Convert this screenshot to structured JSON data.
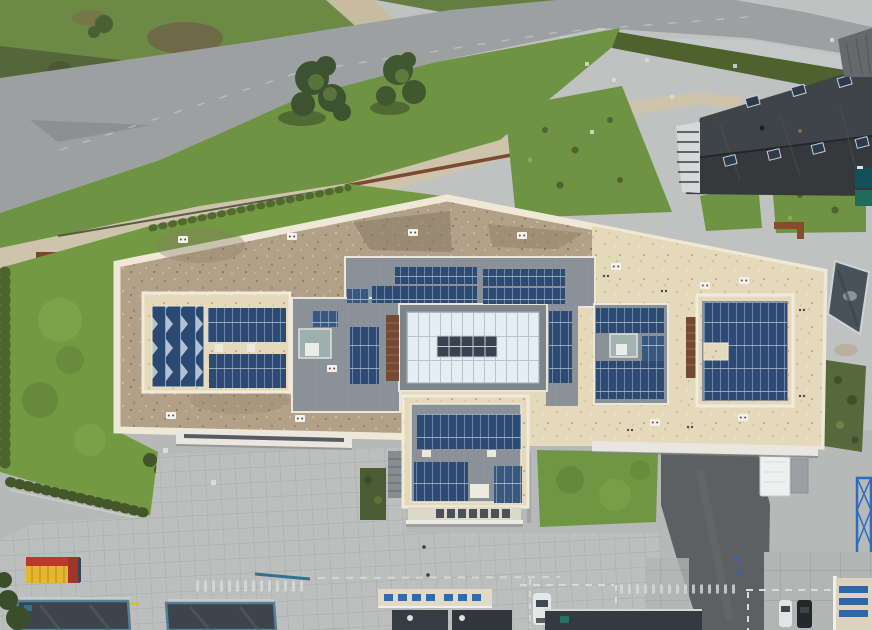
{
  "scene": {
    "type": "aerial-drone-photograph",
    "description": "Top-down aerial drone photo of a large modern flat-roof commercial building covered with photovoltaic solar panel arrays around a central glass atrium skylight, surrounded by a curved road, lawns, hedges, paved plazas, parking areas with dashed markings, a yellow shipping container, a white box truck, cars and neighbouring dark-roofed buildings",
    "view": "nadir (straight down)",
    "lighting": "overcast daylight"
  },
  "palette": {
    "solar_panel_blue": "#2c4a72",
    "solar_panel_light_blue": "#38587f",
    "gravel_roof_brown": "#b2a188",
    "gravel_roof_cream": "#e5d9bb",
    "roof_tile_grey": "#8b9299",
    "skylight_glass": "#e4eef4",
    "parapet_white": "#efe8d6",
    "grass_green": "#6f9743",
    "hedge_green": "#4a5e2d",
    "asphalt_road_grey": "#9ca0a1",
    "concrete_plaza_grey": "#bdbfbe",
    "dark_asphalt": "#5d6062",
    "neighbor_dark_roof": "#35393c",
    "rust_brown": "#744a35",
    "container_yellow": "#e5b62f",
    "container_red": "#b93a2c",
    "truck_white": "#eef0ef",
    "facade_blue": "#2e6bb4"
  },
  "main_building": {
    "roof_shape": "elongated angular flat roof with white parapets",
    "solar_panel_arrays": 18,
    "sawtooth_array": 1,
    "central_skylight": {
      "glass_grid_columns": 12,
      "glass_grid_rows": 3,
      "dark_roof_vents": 10
    },
    "small_square_skylights": 2,
    "rust_collector_strips": 2,
    "white_vent_boxes": 12,
    "annex": {
      "solar_panel_arrays": 3,
      "loading_bays": 7
    }
  },
  "surroundings": {
    "roads": "curved two-lane road running from left edge to upper right corner with traffic island and fork",
    "lawns": 6,
    "hedgerows": 4,
    "trees": 3,
    "neighbor_buildings": [
      "black gable-roof building with roof windows and half-timbered gable (top right)",
      "grey ribbed roof (top right corner)",
      "two dark flat-roof halls with blue-green steel frames (bottom left)",
      "cream facade building with blue windows (bottom center)",
      "cream building with blue window bands and blue lattice mast (bottom right)"
    ],
    "vehicles": {
      "white_box_truck": 1,
      "white_cars": 2,
      "black_cars": 1
    },
    "shipping_container": {
      "body": "yellow",
      "top_and_cap": "red"
    },
    "ground": {
      "concrete_slab_grid_plaza": true,
      "dashed_white_parking_markings": true,
      "dark_asphalt_loading_drive": true
    }
  }
}
